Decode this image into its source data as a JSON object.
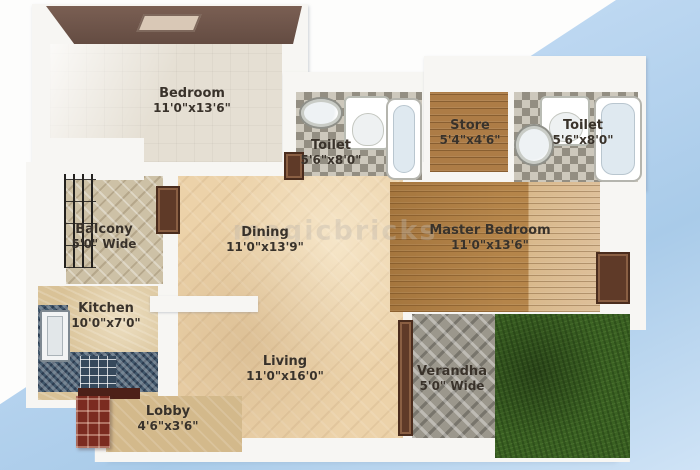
{
  "watermark": "magicbricks",
  "rooms": {
    "bedroom": {
      "name": "Bedroom",
      "dims": "11'0\"x13'6\""
    },
    "toilet1": {
      "name": "Toilet",
      "dims": "5'6\"x8'0\""
    },
    "store": {
      "name": "Store",
      "dims": "5'4\"x4'6\""
    },
    "toilet2": {
      "name": "Toilet",
      "dims": "5'6\"x8'0\""
    },
    "balcony": {
      "name": "Balcony",
      "dims": "5'0\" Wide"
    },
    "dining": {
      "name": "Dining",
      "dims": "11'0\"x13'9\""
    },
    "master_bedroom": {
      "name": "Master Bedroom",
      "dims": "11'0\"x13'6\""
    },
    "kitchen": {
      "name": "Kitchen",
      "dims": "10'0\"x7'0\""
    },
    "living": {
      "name": "Living",
      "dims": "11'0\"x16'0\""
    },
    "lobby": {
      "name": "Lobby",
      "dims": "4'6\"x3'6\""
    },
    "verandha": {
      "name": "Verandha",
      "dims": "5'0\" Wide"
    }
  },
  "fixtures": [
    "sink",
    "toilet",
    "bathtub",
    "fridge",
    "stove",
    "balcony-railing",
    "entrance-steps",
    "lawn"
  ],
  "colors": {
    "background_blue": "#b7d4ef",
    "wall_white": "#f7f6f3",
    "parquet_beige": "#ecd2a9",
    "master_wood": "#b5854a",
    "store_wood": "#ad7c46",
    "tile_checker_dark": "#938e82",
    "verandha_gray": "#9b978c",
    "lawn_green": "#3a6122",
    "roof_brown": "#6e564c",
    "counter_blue": "#41576b",
    "entrance_brick": "#7b2b20",
    "door_brown": "#5f3a28",
    "label_text": "#39322a"
  }
}
